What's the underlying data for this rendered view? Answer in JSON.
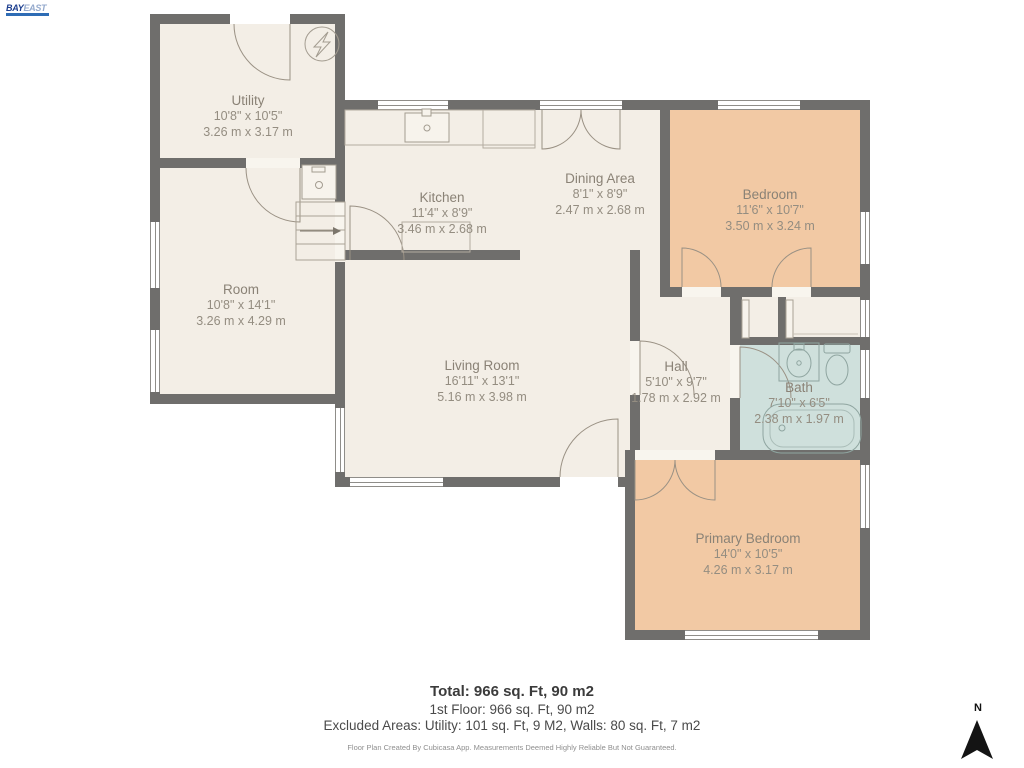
{
  "logo": {
    "primary": "BAY",
    "secondary": "EAST"
  },
  "rooms": [
    {
      "name": "Utility",
      "imperial": "10'8\" x 10'5\"",
      "metric": "3.26 m x 3.17 m"
    },
    {
      "name": "Kitchen",
      "imperial": "11'4\" x 8'9\"",
      "metric": "3.46 m x 2.68 m"
    },
    {
      "name": "Dining Area",
      "imperial": "8'1\" x 8'9\"",
      "metric": "2.47 m x 2.68 m"
    },
    {
      "name": "Bedroom",
      "imperial": "11'6\" x 10'7\"",
      "metric": "3.50 m x 3.24 m"
    },
    {
      "name": "Room",
      "imperial": "10'8\" x 14'1\"",
      "metric": "3.26 m x 4.29 m"
    },
    {
      "name": "Living Room",
      "imperial": "16'11\" x 13'1\"",
      "metric": "5.16 m x 3.98 m"
    },
    {
      "name": "Hall",
      "imperial": "5'10\" x 9'7\"",
      "metric": "1.78 m x 2.92 m"
    },
    {
      "name": "Bath",
      "imperial": "7'10\" x 6'5\"",
      "metric": "2.38 m x 1.97 m"
    },
    {
      "name": "Primary Bedroom",
      "imperial": "14'0\" x 10'5\"",
      "metric": "4.26 m x 3.17 m"
    }
  ],
  "summary": {
    "total": "Total: 966 sq. Ft, 90 m2",
    "floor": "1st Floor: 966 sq. Ft, 90 m2",
    "excluded": "Excluded Areas: Utility: 101 sq. Ft, 9 M2, Walls: 80 sq. Ft, 7 m2",
    "disclaimer": "Floor Plan Created By Cubicasa App. Measurements Deemed Highly Reliable But Not Guaranteed."
  },
  "compass": {
    "label": "N"
  },
  "colors": {
    "wall": "#6f6e6c",
    "floor": "#f3eee6",
    "bedroom_floor": "#f2c9a4",
    "bath_floor": "#cfe0dc",
    "label_text": "#8a8276",
    "logo_blue": "#2e6cb5"
  },
  "fixtures": [
    "electric-meter",
    "washer",
    "stairs-up-arrow",
    "kitchen-sink",
    "kitchen-counter",
    "appliance",
    "bath-sink",
    "toilet",
    "bathtub",
    "north-arrow"
  ]
}
